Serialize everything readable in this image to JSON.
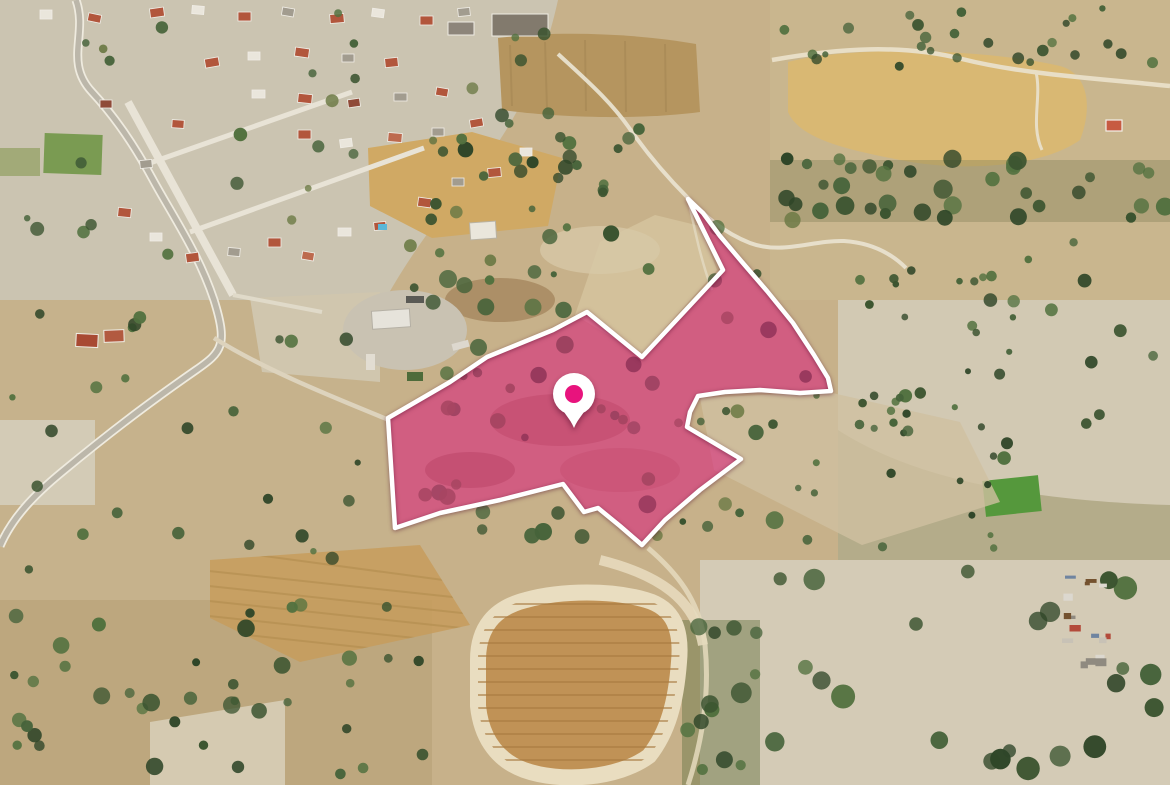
{
  "colors": {
    "terrain-base": "#c7b18a",
    "village-ground": "#cbc4b1",
    "pale-field": "#d2c9b3",
    "gold-field": "#d0a964",
    "wheat-field": "#d9b873",
    "plow-brown": "#b5955f",
    "plowed-gold": "#c09256",
    "furrow": "#a87c42",
    "cream-track": "#e9ddc0",
    "road-light": "#efebdf",
    "road-asphalt": "#bcb7aa",
    "tree-dark": "#3b5430",
    "tree-mid": "#46633a",
    "scrub-green": "#6c7a45",
    "green-field": "#7a9b52",
    "bright-green": "#55983c",
    "roof-terracotta": "#b2563c",
    "roof-white": "#eae6dc",
    "roof-gray": "#a29c8f",
    "parcel-fill": "#d91a7a",
    "parcel-outline": "#ffffff",
    "pin-body": "#ffffff",
    "pin-dot": "#e8137d"
  },
  "parcel": {
    "points": "688,199 703,213 720,236 742,262 767,291 793,323 814,355 828,378 831,391 800,393 760,390 725,392 698,396 690,412 687,427 741,459 700,490 665,520 642,545 620,526 598,508 584,512 563,484 500,500 440,513 395,528 388,418 450,382 487,357 553,330 587,312 642,357 723,270",
    "fill_opacity": "0.55"
  },
  "pin": {
    "x": 574,
    "y": 394,
    "transform": "translate(574,394)"
  }
}
